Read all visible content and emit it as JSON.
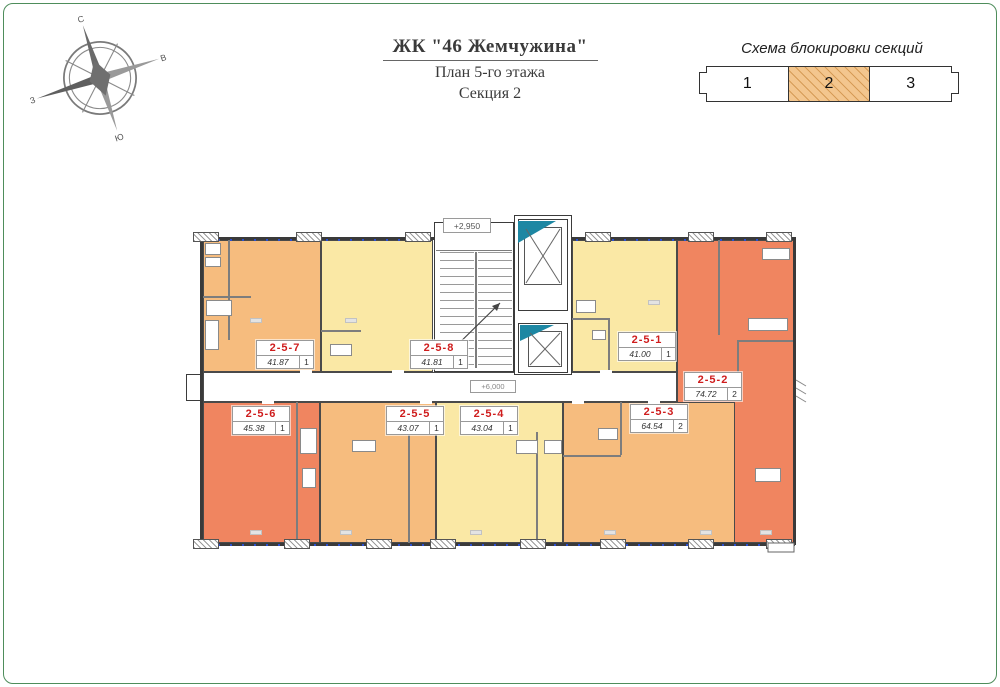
{
  "header": {
    "title": "ЖК \"46 Жемчужина\"",
    "subtitle": "План 5-го этажа",
    "section_label": "Секция 2"
  },
  "compass": {
    "n": "С",
    "e": "В",
    "s": "Ю",
    "w": "З"
  },
  "blocking_scheme": {
    "title": "Схема блокировки секций",
    "sections": [
      "1",
      "2",
      "3"
    ],
    "active_section": "2",
    "active_fill": "#f3c68e"
  },
  "plan": {
    "label_color": "#cf1d1d",
    "stair_elevation": "+2,950",
    "corridor_elevation": "+6,000",
    "palette": {
      "orange": "#f6bc7e",
      "yellow": "#fae8a5",
      "salmon": "#f08560",
      "elevator_accent": "#1d87a3"
    },
    "units": [
      {
        "id": "2-5-1",
        "area": "41.00",
        "rooms": "1",
        "fill": "#fae8a5"
      },
      {
        "id": "2-5-2",
        "area": "74.72",
        "rooms": "2",
        "fill": "#f08560"
      },
      {
        "id": "2-5-3",
        "area": "64.54",
        "rooms": "2",
        "fill": "#f6bc7e"
      },
      {
        "id": "2-5-4",
        "area": "43.04",
        "rooms": "1",
        "fill": "#fae8a5"
      },
      {
        "id": "2-5-5",
        "area": "43.07",
        "rooms": "1",
        "fill": "#f6bc7e"
      },
      {
        "id": "2-5-6",
        "area": "45.38",
        "rooms": "1",
        "fill": "#f08560"
      },
      {
        "id": "2-5-7",
        "area": "41.87",
        "rooms": "1",
        "fill": "#f6bc7e"
      },
      {
        "id": "2-5-8",
        "area": "41.81",
        "rooms": "1",
        "fill": "#fae8a5"
      }
    ]
  }
}
